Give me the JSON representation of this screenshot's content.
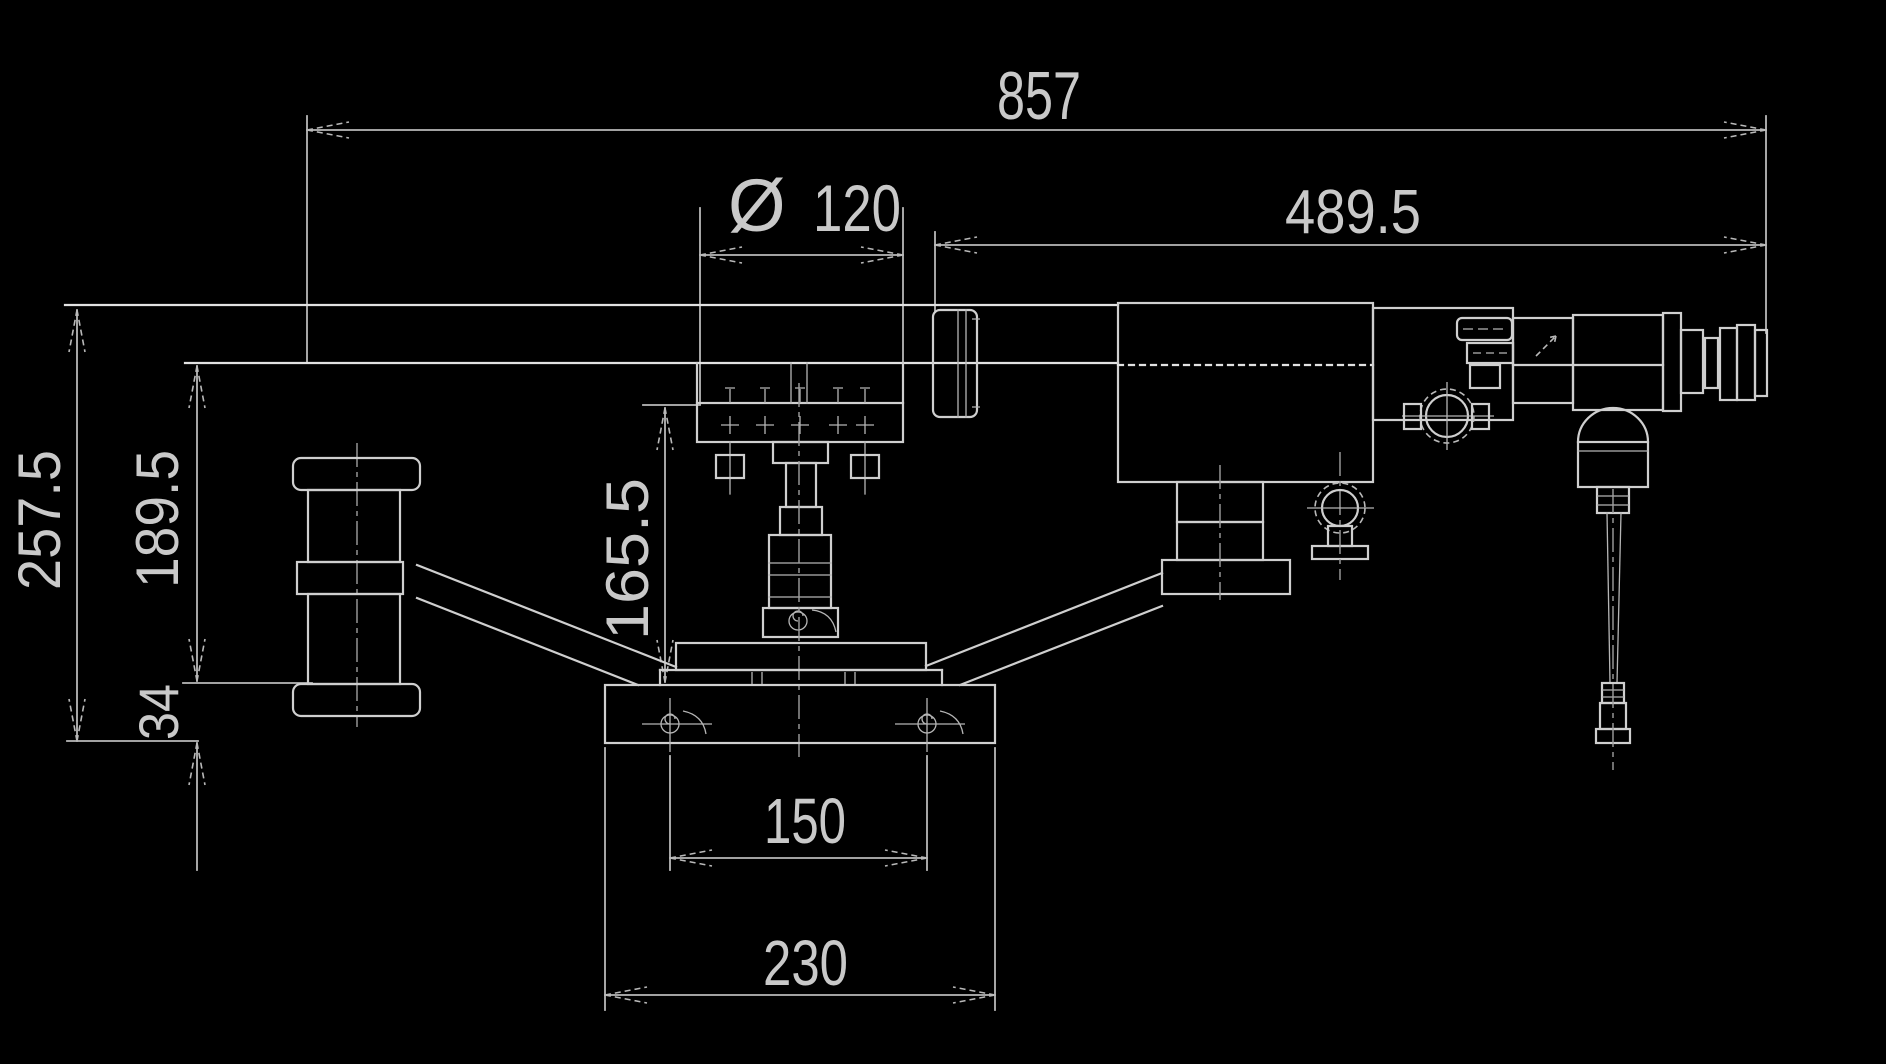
{
  "drawing": {
    "type": "engineering-dimension-drawing",
    "dimensions": {
      "total_length": "857",
      "upper_length": "489.5",
      "diameter_symbol": "Ø",
      "diameter_value": "120",
      "total_height": "257.5",
      "rail_height": "189.5",
      "spindle_height": "165.5",
      "base_height": "34",
      "anchor_spacing": "150",
      "base_width": "230"
    },
    "colors": {
      "background": "#000000",
      "line": "#cfcfcf",
      "dimension_line": "#b9b9b9",
      "text": "#c9c9c9"
    }
  }
}
